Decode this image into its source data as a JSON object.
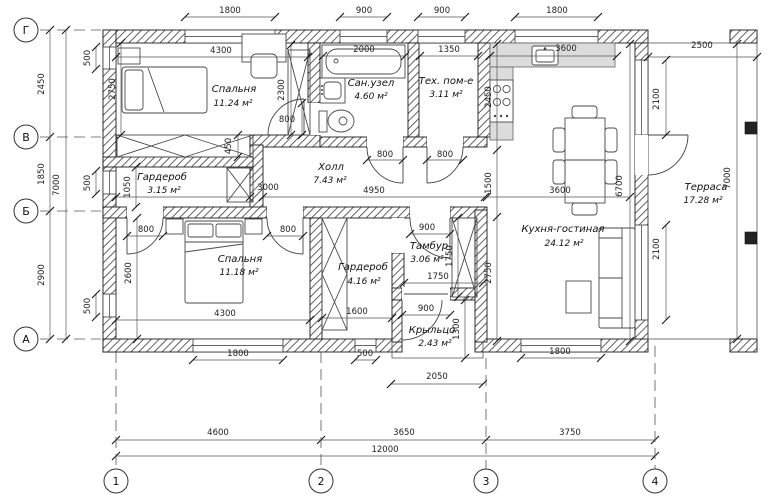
{
  "plan_title": "План дома 12000x7000",
  "axes": {
    "cols": [
      "1",
      "2",
      "3",
      "4"
    ],
    "rows": [
      "Г",
      "В",
      "Б",
      "А"
    ]
  },
  "rooms": {
    "bedroom1": {
      "name": "Спальня",
      "area": "11.24 м²"
    },
    "bathroom": {
      "name": "Сан.узел",
      "area": "4.60 м²"
    },
    "tech": {
      "name": "Тех. пом-е",
      "area": "3.11 м²"
    },
    "hall": {
      "name": "Холл",
      "area": "7.43 м²"
    },
    "wardrobe1": {
      "name": "Гардероб",
      "area": "3.15 м²"
    },
    "bedroom2": {
      "name": "Спальня",
      "area": "11.18 м²"
    },
    "wardrobe2": {
      "name": "Гардероб",
      "area": "4.16 м²"
    },
    "vestibule": {
      "name": "Тамбур",
      "area": "3.06 м²"
    },
    "porch": {
      "name": "Крыльцо",
      "area": "2.43 м²"
    },
    "kitchen": {
      "name": "Кухня-гостиная",
      "area": "24.12 м²"
    },
    "terrace": {
      "name": "Терраса",
      "area": "17.28 м²"
    }
  },
  "dims": {
    "top_win_bedroom1": "1800",
    "top_win_bath": "900",
    "top_win_tech": "900",
    "top_win_kitchen": "1800",
    "bedroom1_width": "4300",
    "bathtub": "2000",
    "tech_width": "1350",
    "kitchen_counter": "3600",
    "terrace_width": "2500",
    "row_g_v": "2450",
    "row_v_b": "1850",
    "row_b_a": "2900",
    "rows_total": "7000",
    "win_left_1": "500",
    "win_left_2": "500",
    "win_left_3": "500",
    "bedroom1_depth": "2750",
    "wardrobe_b1_h": "2300",
    "door_bedroom1": "800",
    "wardrobe_b1_d": "450",
    "door_bath": "800",
    "door_tech": "800",
    "hall_length": "4950",
    "wardrobe1_w": "1050",
    "wardrobe1_len": "3000",
    "kit_zone": "2450",
    "mid_zone": "1500",
    "living_zone": "2750",
    "dining_w": "3600",
    "living_len": "6700",
    "win_terr_1": "2100",
    "win_terr_2": "2100",
    "terrace_len": "7000",
    "door_b2_left": "800",
    "door_b2_right": "800",
    "bedroom2_depth": "2600",
    "bedroom2_width": "4300",
    "win_bedroom2": "1800",
    "wardrobe2_len": "1600",
    "win_small": "500",
    "door_vest": "900",
    "vest_w": "1750",
    "vest_closet": "1750",
    "door_porch": "900",
    "porch_d": "1300",
    "porch_w": "2050",
    "win_living": "1800",
    "span_1_2": "4600",
    "span_2_3": "3650",
    "span_3_4": "3750",
    "span_total": "12000"
  }
}
